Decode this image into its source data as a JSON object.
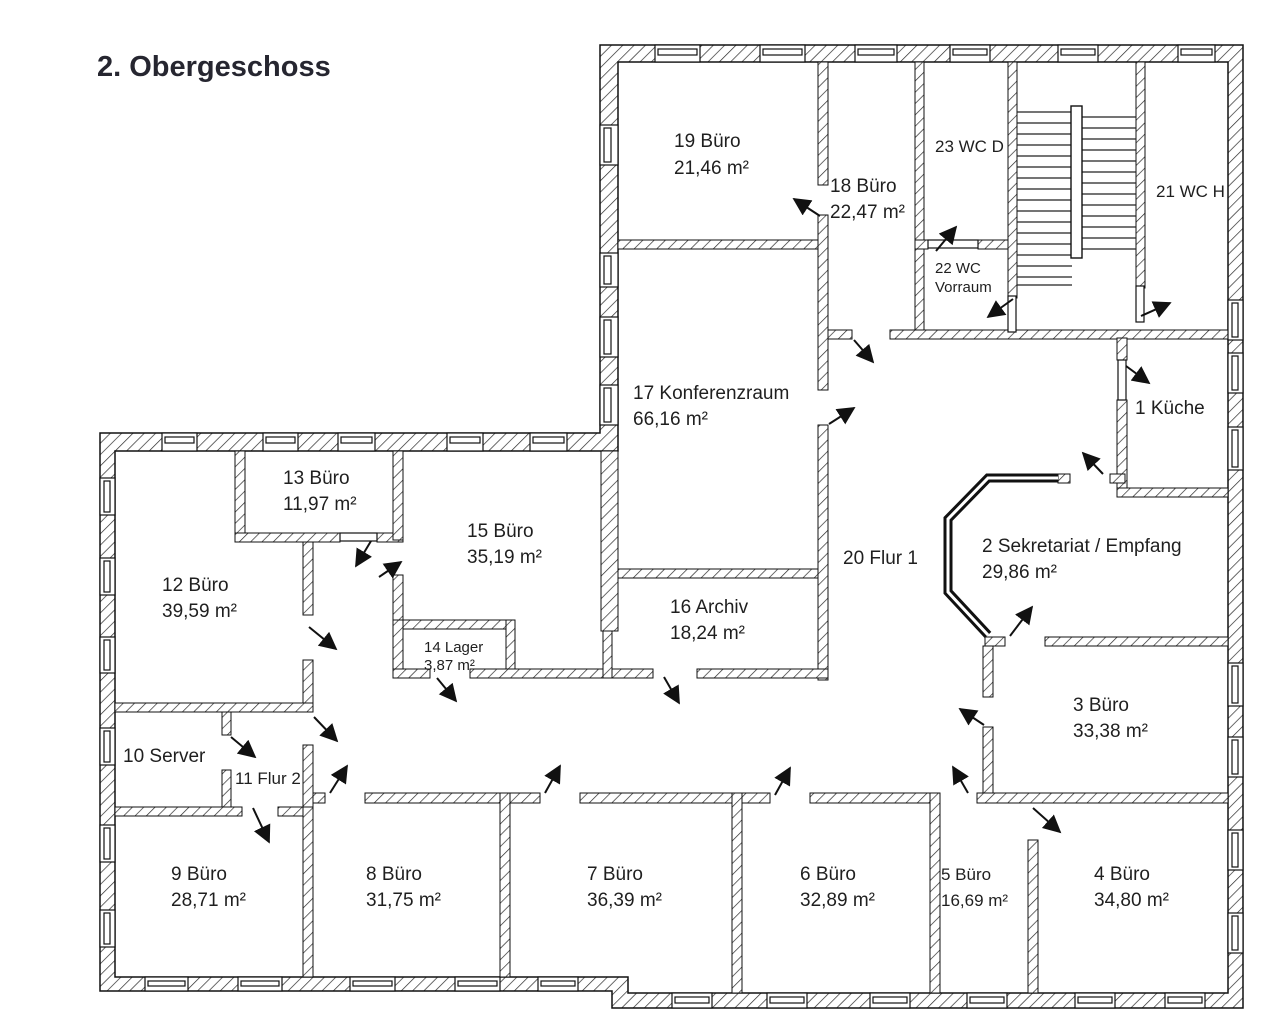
{
  "title": "2. Obergeschoss",
  "rooms": [
    {
      "name": "1 Küche",
      "detail": ""
    },
    {
      "name": "2 Sekretariat / Empfang",
      "detail": "29,86 m²"
    },
    {
      "name": "3 Büro",
      "detail": "33,38 m²"
    },
    {
      "name": "4 Büro",
      "detail": "34,80 m²"
    },
    {
      "name": "5 Büro",
      "detail": "16,69 m²"
    },
    {
      "name": "6 Büro",
      "detail": "32,89 m²"
    },
    {
      "name": "7 Büro",
      "detail": "36,39 m²"
    },
    {
      "name": "8 Büro",
      "detail": "31,75 m²"
    },
    {
      "name": "9 Büro",
      "detail": "28,71 m²"
    },
    {
      "name": "10 Server",
      "detail": ""
    },
    {
      "name": "11 Flur 2",
      "detail": ""
    },
    {
      "name": "12 Büro",
      "detail": "39,59 m²"
    },
    {
      "name": "13 Büro",
      "detail": "11,97 m²"
    },
    {
      "name": "14 Lager",
      "detail": "3,87 m²"
    },
    {
      "name": "15 Büro",
      "detail": "35,19 m²"
    },
    {
      "name": "16 Archiv",
      "detail": "18,24 m²"
    },
    {
      "name": "17 Konferenzraum",
      "detail": "66,16 m²"
    },
    {
      "name": "18 Büro",
      "detail": "22,47 m²"
    },
    {
      "name": "19 Büro",
      "detail": "21,46 m²"
    },
    {
      "name": "20 Flur 1",
      "detail": ""
    },
    {
      "name": "21 WC H",
      "detail": ""
    },
    {
      "name": "22 WC",
      "detail": "Vorraum"
    },
    {
      "name": "23 WC D",
      "detail": ""
    }
  ]
}
